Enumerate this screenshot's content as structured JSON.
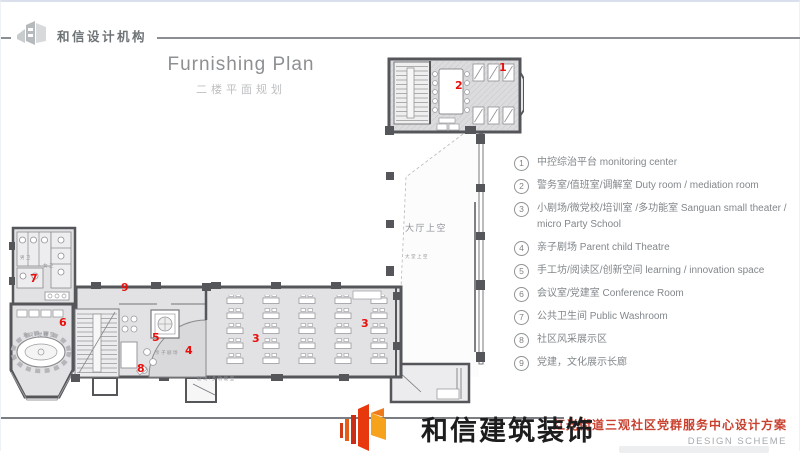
{
  "header": {
    "brand": "和信设计机构",
    "title": "Furnishing Plan",
    "subtitle": "二楼平面规划"
  },
  "legend": {
    "items": [
      {
        "num": "1",
        "text": "中控综治平台 monitoring center"
      },
      {
        "num": "2",
        "text": "警务室/值班室/调解室  Duty room / mediation room"
      },
      {
        "num": "3",
        "text": "小剧场/微党校/培训室 /多功能室  Sanguan small theater / micro Party School"
      },
      {
        "num": "4",
        "text": "亲子剧场 Parent child Theatre"
      },
      {
        "num": "5",
        "text": "手工坊/阅读区/创新空间  learning / innovation space"
      },
      {
        "num": "6",
        "text": "会议室/党建室  Conference Room"
      },
      {
        "num": "7",
        "text": "公共卫生间  Public Washroom"
      },
      {
        "num": "8",
        "text": "社区风采展示区"
      },
      {
        "num": "9",
        "text": "党建，文化展示长廊"
      }
    ]
  },
  "plan": {
    "markers": [
      {
        "n": "1",
        "x": 490,
        "y": 10
      },
      {
        "n": "2",
        "x": 446,
        "y": 28
      },
      {
        "n": "3",
        "x": 243,
        "y": 281
      },
      {
        "n": "3",
        "x": 352,
        "y": 266
      },
      {
        "n": "4",
        "x": 176,
        "y": 293
      },
      {
        "n": "5",
        "x": 143,
        "y": 280
      },
      {
        "n": "6",
        "x": 50,
        "y": 265
      },
      {
        "n": "7",
        "x": 21,
        "y": 221
      },
      {
        "n": "8",
        "x": 128,
        "y": 311
      },
      {
        "n": "9",
        "x": 112,
        "y": 230
      }
    ],
    "labels": [
      {
        "text": "大厅上空",
        "x": 396,
        "y": 172,
        "s": 9
      },
      {
        "text": "大堂上空",
        "x": 396,
        "y": 203,
        "s": 4.5
      },
      {
        "text": "会议/党建室",
        "x": 14,
        "y": 281,
        "s": 4.5
      },
      {
        "text": "亲子剧场",
        "x": 146,
        "y": 299,
        "s": 4.5
      },
      {
        "text": "剧场/多功能室",
        "x": 188,
        "y": 325,
        "s": 4.5
      },
      {
        "text": "男卫",
        "x": 11,
        "y": 204,
        "s": 4.5
      },
      {
        "text": "女卫",
        "x": 34,
        "y": 212,
        "s": 4.5
      }
    ]
  },
  "footer": {
    "company": "和信建筑装饰",
    "project": "红光街道三观社区党群服务中心设计方案",
    "scheme": "DESIGN SCHEME"
  },
  "colors": {
    "marker_red": "#e8100c",
    "accent_red": "#c9402f",
    "wall": "#55565a",
    "floor": "#e3e3e5"
  }
}
